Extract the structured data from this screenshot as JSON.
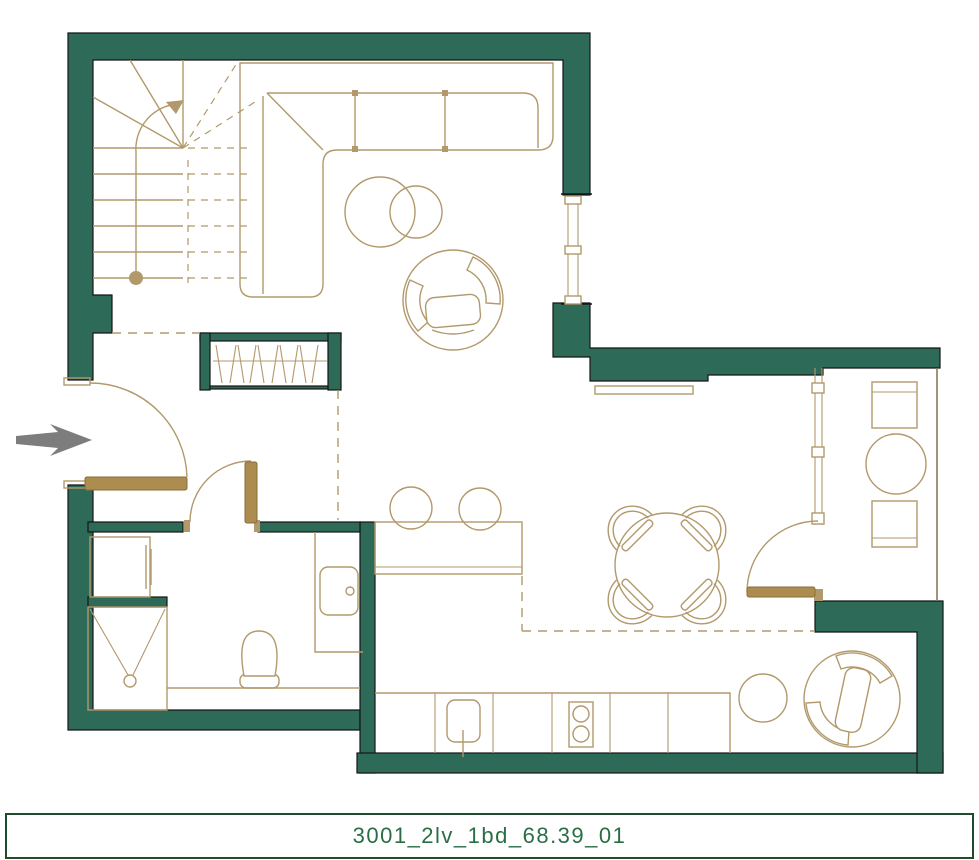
{
  "plan": {
    "label": "3001_2lv_1bd_68.39_01",
    "type_note": "floor plan drawing",
    "furniture": [
      "staircase",
      "wardrobe",
      "corner-sofa",
      "coffee-tables",
      "armchair",
      "window",
      "washing-machine",
      "shower",
      "toilet",
      "sink-vanity",
      "kitchen-counter",
      "kitchen-sink",
      "cooktop",
      "bar-counter",
      "bar-stools",
      "dining-table",
      "dining-chairs",
      "balcony-chairs",
      "balcony-table",
      "lounge-armchair",
      "side-table",
      "entrance-arrow"
    ]
  },
  "colors": {
    "wall": "#2E6A58",
    "outline": "#161616",
    "line": "#B2996B",
    "door": "#AC8C4F",
    "arrow": "#7D7D7D",
    "label-text": "#2A6E46",
    "label-border": "#1D4D2C",
    "bg": "#FFFFFF"
  }
}
